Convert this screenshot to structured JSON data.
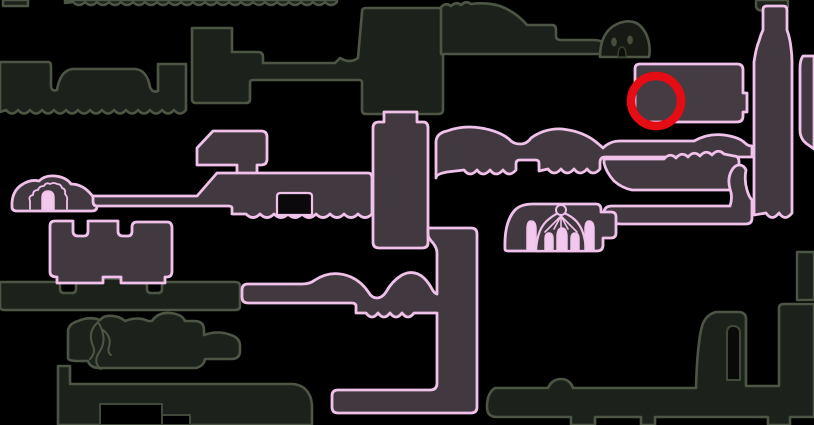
{
  "meta": {
    "width": 814,
    "height": 425,
    "background": "#000000"
  },
  "palette": {
    "background": "#000000",
    "unexplored_outline": "#4d5645",
    "unexplored_fill": "#1d211b",
    "explored_outline": "#f0c2ea",
    "explored_fill": "#423840",
    "icon_pink_fill": "#f3c8ee",
    "annotation_red": "#e50d13"
  },
  "annotation": {
    "name": "red-circle-marker",
    "shape": "circle",
    "cx": 656,
    "cy": 101,
    "r": 25,
    "stroke_width": 8.5,
    "color": "#e50d13"
  },
  "map": {
    "layers": [
      {
        "name": "unexplored-rooms",
        "items": [
          {
            "name": "room-top-strip",
            "kind": "path",
            "fill": "#1d211b",
            "stroke": "#4d5645",
            "sw": 2.4,
            "d": "M65,0 H337 V2 q-6,6 -12,0 q-6,6 -12,0 q-6,6 -12,0 q-6,6 -12,0 q-6,6 -12,0 q-6,6 -12,0 q-6,6 -12,0 q-6,6 -12,0 q-6,6 -12,0 q-6,6 -12,0 q-6,6 -12,0 q-6,6 -12,0 q-6,6 -12,0 q-6,6 -12,0 q-6,6 -12,0 q-6,6 -12,0 q-6,6 -12,0 q-6,6 -12,0 q-6,6 -12,0 q-6,6 -12,0 q-6,6 -12,0 q-6,6 -12,0 L65,3 Z"
          },
          {
            "name": "room-top-left-block",
            "kind": "path",
            "fill": "#1d211b",
            "stroke": "#4d5645",
            "sw": 2.4,
            "d": "M3,0 H28 V6 H3 Z"
          },
          {
            "name": "room-left-band",
            "kind": "path",
            "fill": "#1d211b",
            "stroke": "#4d5645",
            "sw": 2.6,
            "d": "M0,62 H48 Q51,62 51,66 V85 Q51,92 57,90 Q60,71 72,69 H135 Q147,70 150,87 Q152,93 158,91 V64 H186 V110 q-6,7 -12,0 q-6,7 -12,0 q-6,7 -12,0 q-6,7 -12,0 q-6,7 -12,0 q-6,7 -12,0 q-6,7 -12,0 q-6,7 -12,0 q-6,7 -12,0 q-6,7 -12,0 q-6,7 -12,0 q-6,7 -12,0 q-6,7 -12,0 q-6,7 -12,0 q-6,7 -12,0 L0,112 Z"
          },
          {
            "name": "room-upper-mid-complex",
            "kind": "path",
            "fill": "#1d211b",
            "stroke": "#4d5645",
            "sw": 2.6,
            "d": "M192,28 L232,28 L232,52 L258,52 Q263,52 263,57 L263,63 L335,63 L340,58 Q350,64 358,58 L362,12 Q362,8 366,8 L438,8 Q443,8 443,13 L443,110 Q443,114 438,114 L366,114 Q362,114 362,110 L362,82 Q362,80 358,80 L253,80 Q250,80 250,83 L250,99 Q250,103 246,103 L196,103 Q192,103 192,99 Z"
          },
          {
            "name": "room-top-lump-bar",
            "kind": "path",
            "fill": "#1d211b",
            "stroke": "#4d5645",
            "sw": 2.6,
            "d": "M441,54 V7 q5,-5 10,-1 q5,-5 10,-1 q5,-5 10,-1 Q486,2 500,6 Q516,12 527,25 L552,25 Q556,25 556,30 V36 Q556,40 561,40 L593,40 Q603,40 604,45 V48 Q604,54 598,54 Z"
          },
          {
            "name": "room-mound-with-eyes",
            "kind": "path",
            "fill": "#171a14",
            "stroke": "#4d5645",
            "sw": 2.6,
            "d": "M600,57 Q600,32 617,24 Q638,15 647,36 Q651,47 649,57 Z"
          },
          {
            "name": "room-top-right-hook",
            "kind": "path",
            "fill": "#1d211b",
            "stroke": "#4d5645",
            "sw": 2.4,
            "d": "M756,0 H788 V7 Q777,12 766,10 Q758,12 756,7 Z"
          },
          {
            "name": "room-left-corridor",
            "kind": "path",
            "fill": "#1d211b",
            "stroke": "#4d5645",
            "sw": 2.6,
            "d": "M0,282 H57 Q60,282 60,286 V289 Q60,293 64,293 H72 Q76,293 76,289 V286 Q76,282 81,281 Q103,276 143,281 Q147,282 147,286 V289 Q147,293 151,293 H158 Q162,293 162,289 V286 Q162,282 166,282 H235 Q240,282 240,286 V306 Q240,310 235,310 H4 Q0,310 0,306 Z"
          },
          {
            "name": "room-vine",
            "kind": "path",
            "fill": "#1d211b",
            "stroke": "#4d5645",
            "sw": 2.6,
            "d": "M68,358 V332 Q68,324 78,321 Q90,316 100,320 Q104,315 113,316 Q121,317 125,321 Q138,316 148,321 L152,321 Q158,312 170,313 Q182,314 185,321 L194,321 Q204,321 204,330 L204,335 Q218,330 231,335 Q240,338 240,346 V351 Q240,359 231,359 L205,359 Q204,366 196,368 L100,368 Q90,368 88,361 L78,361 Q68,361 68,358 Z"
          },
          {
            "name": "room-bottom-left-corridor",
            "kind": "path",
            "fill": "#1d211b",
            "stroke": "#4d5645",
            "sw": 2.6,
            "d": "M58,366 H70 V384 H293 Q304,385 309,394 Q312,399 312,408 V425 H58 Z"
          },
          {
            "name": "bottom-left-corridor-cutout",
            "kind": "path",
            "fill": "#000000",
            "stroke": "#414a3a",
            "sw": 2,
            "d": "M100,404 H162 V425 H100 Z"
          },
          {
            "name": "bottom-left-corridor-step",
            "kind": "path",
            "fill": "#000000",
            "stroke": "#414a3a",
            "sw": 2,
            "d": "M162,415 H190 V425 H162 Z"
          },
          {
            "name": "room-bottom-right-corridor",
            "kind": "path",
            "fill": "#1d211b",
            "stroke": "#4d5645",
            "sw": 2.6,
            "d": "M495,388 L548,388 Q552,379 561,379 Q570,379 573,388 L696,388 Q697,350 701,330 Q704,315 716,312 L738,312 Q746,312 746,319 L746,386 L779,386 L779,308 Q779,304 784,304 L814,304 L814,417 L790,417 L790,425 L768,425 L768,417 L655,417 L655,425 L641,425 L641,417 L595,417 L595,425 L571,425 L571,417 L497,417 Q487,417 487,407 Q487,393 495,388 Z"
          },
          {
            "name": "boot-tower-notch",
            "kind": "path",
            "fill": "#0a0b09",
            "stroke": "#414a3a",
            "sw": 2,
            "d": "M727,380 V333 Q727,326 733,326 Q740,326 740,333 V380 Z"
          },
          {
            "name": "room-right-edge-small",
            "kind": "path",
            "fill": "#1d211b",
            "stroke": "#4d5645",
            "sw": 2.4,
            "d": "M797,252 H814 V300 H797 Z"
          }
        ]
      },
      {
        "name": "explored-rooms",
        "items": [
          {
            "name": "room-mound-entrance",
            "kind": "path",
            "fill": "#423840",
            "stroke": "#f0c2ea",
            "sw": 2.8,
            "d": "M12,207 Q11,191 23,184 Q31,179 39,181 Q45,175 55,176 Q66,177 71,184 Q81,184 89,192 Q96,199 97,206 Q97,211 92,211 L17,211 Q12,211 12,207 Z"
          },
          {
            "name": "room-pentagon",
            "kind": "path",
            "fill": "#423840",
            "stroke": "#f0c2ea",
            "sw": 2.8,
            "d": "M197,165 V148 L213,131 L261,131 Q267,131 267,137 V159 Q267,165 261,165 L257,165 V175 Q257,179 252,179 L242,179 Q237,179 237,175 V165 Z"
          },
          {
            "name": "room-wide-left",
            "kind": "path",
            "fill": "#423840",
            "stroke": "#f0c2ea",
            "sw": 2.8,
            "d": "M93,196 L197,196 L217,173 L368,173 Q372,173 372,178 V214 q-7,7 -14,0 q-7,7 -14,0 q-7,7 -14,0 q-7,7 -14,0 q-7,7 -14,0 q-7,7 -14,0 q-7,7 -14,0 q-7,7 -14,0 q-7,7 -14,0 L232,214 L232,208 Q232,206 228,206 L97,206 Q93,206 93,201 Z"
          },
          {
            "name": "wide-room-floor-step",
            "kind": "path",
            "fill": "#0b090c",
            "stroke": "#f0c2ea",
            "sw": 2.2,
            "d": "M277,215 V196 Q277,193 281,193 L308,193 Q312,193 312,196 V215 Z"
          },
          {
            "name": "shaft-upper",
            "kind": "path",
            "fill": "#423840",
            "stroke": "#f0c2ea",
            "sw": 2.8,
            "d": "M384,112 L417,112 L417,122 L423,122 Q428,122 428,128 L428,243 Q428,248 422,248 L379,248 Q373,248 373,242 L373,128 Q373,122 379,122 L384,122 Z"
          },
          {
            "name": "shaft-lower-with-arm-and-bottom-corridor",
            "kind": "path",
            "fill": "#423840",
            "stroke": "#f0c2ea",
            "sw": 2.8,
            "d": "M428,228 L471,228 Q477,228 477,234 L477,407 Q477,413 471,413 L338,413 Q332,413 332,407 L332,396 Q332,390 338,390 L430,390 Q437,390 437,383 L437,313 L414,313 q-6,8 -12,0 q-6,8 -12,0 q-6,8 -12,0 q-6,8 -12,0 L356,313 L356,306 Q356,303 351,303 L248,303 Q242,303 242,297 L242,290 Q242,284 248,284 L302,284 Q310,284 315,280 Q332,269 351,277 Q362,282 369,293 Q372,298 377,298 Q382,298 386,292 Q392,281 402,275 Q414,269 424,278 Q429,283 432,289 Q434,293 437,294 L437,253 Q437,248 433,243 Q428,238 428,234 Z"
          },
          {
            "name": "room-notched-lower-left",
            "kind": "path",
            "fill": "#423840",
            "stroke": "#f0c2ea",
            "sw": 2.8,
            "d": "M50,272 V226 Q50,221 55,221 L73,221 L73,231 Q73,236 78,236 L84,236 Q88,236 88,231 L88,221 L118,221 L118,231 Q118,236 123,236 L128,236 Q132,236 132,231 L132,227 Q132,222 137,222 L167,222 Q172,222 172,228 V271 Q172,277 167,277 L165,277 V283 L121,283 L121,277 L103,277 L103,283 L57,283 L57,277 Q50,277 50,272 Z"
          },
          {
            "name": "room-humped-corridor-right-of-shaft",
            "kind": "path",
            "fill": "#423840",
            "stroke": "#f0c2ea",
            "sw": 2.8,
            "d": "M436,178 L436,141 Q437,133 447,131 Q463,125 481,128 Q499,131 509,139 Q513,144 520,144 Q527,144 531,138 Q545,128 562,129 Q580,131 592,139 Q599,144 603,148 Q610,141 620,141 L694,141 Q708,133 724,135 Q739,137 745,143 Q748,146 752,146 L752,157 L605,157 Q600,157 600,163 L600,169 q-7,8 -13,0 q-7,8 -13,0 q-7,8 -13,0 q-7,8 -13,0 L539,171 L539,163 Q539,160 535,160 L520,160 Q516,160 516,164 L516,170 q-7,8 -13,0 q-7,8 -13,0 q-7,8 -13,0 q-7,8 -13,0 L447,172 Q436,174 436,178 Z"
          },
          {
            "name": "room-wavy-top-right",
            "kind": "path",
            "fill": "#423840",
            "stroke": "#f0c2ea",
            "sw": 2.8,
            "d": "M604,159 L664,159 q6,-7 12,-1 q6,-7 12,-1 q6,-7 12,-1 q6,-7 12,-1 q6,-7 12,-1 L734,156 Q739,156 739,162 L739,185 Q737,190 730,190 L632,190 Q622,188 614,181 Q606,172 604,163 Z"
          },
          {
            "name": "corridor-right-lower",
            "kind": "path",
            "fill": "#423840",
            "stroke": "#f0c2ea",
            "sw": 2.8,
            "d": "M604,213 Q604,206 612,206 L730,206 Q733,197 730,189 Q727,178 732,170 Q735,165 739,165 Q744,165 746,170 Q744,180 747,190 Q749,197 752,200 L752,218 Q752,224 746,224 L621,224 Q613,224 610,220 Q607,216 604,214 Z"
          },
          {
            "name": "room-temple",
            "kind": "path",
            "fill": "#423840",
            "stroke": "#f0c2ea",
            "sw": 2.8,
            "d": "M505,249 Q504,222 515,210 Q521,204 533,204 L596,204 Q601,204 601,210 L601,212 L611,212 Q616,212 616,217 L616,233 Q616,238 611,238 L603,238 L603,245 Q603,251 597,251 L508,251 Q505,251 505,249 Z"
          },
          {
            "name": "room-red-circle-target",
            "kind": "path",
            "fill": "#453b43",
            "stroke": "#f0c2ea",
            "sw": 2.8,
            "d": "M640,64 L737,64 Q743,64 743,70 L743,93 L747,93 L747,112 L743,112 L743,116 Q743,122 737,122 L641,122 Q635,122 635,116 L635,69 Q635,64 640,64 Z"
          },
          {
            "name": "shaft-right-bottle",
            "kind": "path",
            "fill": "#423840",
            "stroke": "#f0c2ea",
            "sw": 2.8,
            "d": "M763,10 Q763,6 767,6 L783,6 Q787,6 787,10 L787,30 Q790,38 791,48 Q792,55 792,62 L792,213 q-7,9 -13,0 q-7,9 -13,0 L754,215 L754,62 Q756,48 759,41 Q761,34 763,30 Z"
          },
          {
            "name": "room-right-edge-strip",
            "kind": "path",
            "fill": "#423840",
            "stroke": "#f0c2ea",
            "sw": 2.8,
            "d": "M803,56 Q800,60 800,68 L800,130 Q800,139 807,144 L814,149 L814,56 Z"
          }
        ]
      },
      {
        "name": "icons",
        "items": [
          {
            "name": "mound-arch-jagged-icon",
            "kind": "path",
            "fill": "none",
            "stroke": "#f0c2ea",
            "sw": 1.8,
            "d": "M30,209 V201 q-2,-5 3,-6 q0,-5 5,-5 q1,-4 6,-4 q2,-4 6,-2 q4,-2 7,0 q4,0 5,4 q4,1 3,6 q3,3 2,7 L67,209"
          },
          {
            "name": "mound-arch-door-icon",
            "kind": "path",
            "fill": "#f3c8ee",
            "stroke": "#f0c2ea",
            "sw": 1.5,
            "d": "M42,210 V198 Q42,191 48,191 Q54,191 54,198 V210 Z"
          },
          {
            "name": "mound-eye-left-icon",
            "kind": "ellipse",
            "cx": 614,
            "cy": 42,
            "rx": 2.8,
            "ry": 4.5,
            "fill": "#454f3c",
            "stroke": "none",
            "sw": 0
          },
          {
            "name": "mound-eye-right-icon",
            "kind": "ellipse",
            "cx": 630,
            "cy": 40,
            "rx": 2.8,
            "ry": 4.5,
            "fill": "#454f3c",
            "stroke": "none",
            "sw": 0
          },
          {
            "name": "mound-mouth-icon",
            "kind": "path",
            "fill": "#0c0e09",
            "stroke": "#39402f",
            "sw": 1.4,
            "d": "M618,57 Q618,47 622,47 Q626,47 626,57 Z"
          },
          {
            "name": "vine-squiggle-icon-1",
            "kind": "path",
            "fill": "none",
            "stroke": "#4d5645",
            "sw": 2,
            "d": "M98,322 Q108,338 100,351 Q92,362 101,369"
          },
          {
            "name": "vine-squiggle-icon-2",
            "kind": "path",
            "fill": "none",
            "stroke": "#4d5645",
            "sw": 2,
            "d": "M98,322 Q87,332 93,346 Q96,353 90,359"
          },
          {
            "name": "vine-squiggle-icon-3",
            "kind": "path",
            "fill": "none",
            "stroke": "#4d5645",
            "sw": 2,
            "d": "M103,330 Q112,337 109,347 Q107,352 111,355"
          },
          {
            "name": "temple-dome-icon",
            "kind": "path",
            "fill": "#423840",
            "stroke": "#f0c2ea",
            "sw": 2.2,
            "d": "M536,251 Q537,228 549,219 Q555,214 561,212 Q568,214 574,219 Q585,228 586,251 Z"
          },
          {
            "name": "temple-cap-icon",
            "kind": "circle",
            "cx": 561,
            "cy": 210,
            "r": 5,
            "fill": "#423840",
            "stroke": "#f0c2ea",
            "sw": 2
          },
          {
            "name": "temple-radial-icon-1",
            "kind": "path",
            "fill": "none",
            "stroke": "#f0c2ea",
            "sw": 1.6,
            "d": "M561,216 L545,232"
          },
          {
            "name": "temple-radial-icon-2",
            "kind": "path",
            "fill": "none",
            "stroke": "#f0c2ea",
            "sw": 1.6,
            "d": "M561,216 L554,229"
          },
          {
            "name": "temple-radial-icon-3",
            "kind": "path",
            "fill": "none",
            "stroke": "#f0c2ea",
            "sw": 1.6,
            "d": "M561,216 L561,229"
          },
          {
            "name": "temple-radial-icon-4",
            "kind": "path",
            "fill": "none",
            "stroke": "#f0c2ea",
            "sw": 1.6,
            "d": "M561,216 L568,229"
          },
          {
            "name": "temple-radial-icon-5",
            "kind": "path",
            "fill": "none",
            "stroke": "#f0c2ea",
            "sw": 1.6,
            "d": "M561,216 L577,232"
          },
          {
            "name": "temple-arch-left-icon",
            "kind": "path",
            "fill": "#f3c8ee",
            "stroke": "#f0c2ea",
            "sw": 1.5,
            "d": "M545,251 V239 Q545,233 549,233 Q553,233 553,239 V251 Z"
          },
          {
            "name": "temple-arch-center-icon",
            "kind": "path",
            "fill": "#f3c8ee",
            "stroke": "#f0c2ea",
            "sw": 1.5,
            "d": "M557,251 V237 Q557,228 562,228 Q567,228 567,237 V251 Z"
          },
          {
            "name": "temple-arch-right-icon",
            "kind": "path",
            "fill": "#f3c8ee",
            "stroke": "#f0c2ea",
            "sw": 1.5,
            "d": "M571,251 V239 Q571,233 575,233 Q579,233 579,239 V251 Z"
          },
          {
            "name": "temple-column-left-icon",
            "kind": "path",
            "fill": "#f3c8ee",
            "stroke": "#f0c2ea",
            "sw": 1.5,
            "d": "M527,251 V229 Q527,221 531,221 Q536,221 536,229 V251 Z"
          },
          {
            "name": "temple-column-right-icon",
            "kind": "path",
            "fill": "#f3c8ee",
            "stroke": "#f0c2ea",
            "sw": 1.5,
            "d": "M585,251 V229 Q585,221 589,221 Q594,221 594,229 V251 Z"
          }
        ]
      }
    ]
  }
}
